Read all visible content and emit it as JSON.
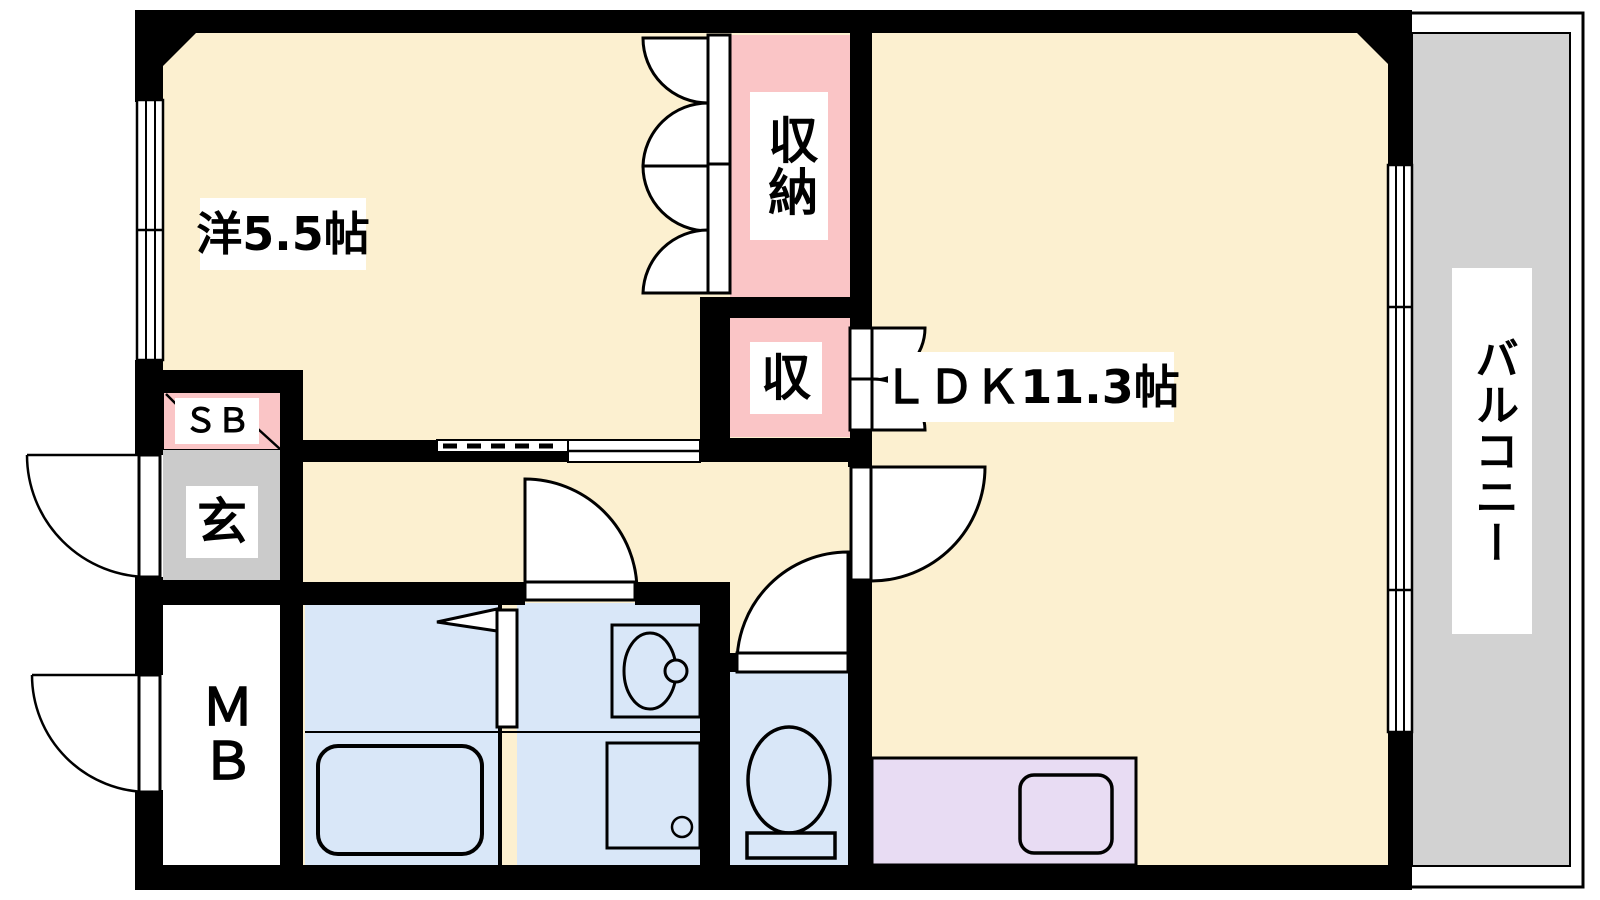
{
  "title": "apartment-floorplan-1LDK",
  "colors": {
    "room_floor": "#FCF0D0",
    "closet_pink": "#FAC5C6",
    "wet_area_blue": "#D9E7F8",
    "entrance_gray": "#CBCBCB",
    "balcony_gray": "#D2D2D2",
    "kitchen_lavender": "#E8DCF3",
    "wall_black": "#000000",
    "white": "#FFFFFF"
  },
  "rooms": {
    "western_room": {
      "label": "洋5.5帖"
    },
    "ldk": {
      "label": "ＬＤＫ11.3帖"
    },
    "closet": {
      "label": "収納"
    },
    "closet_small": {
      "label": "収"
    },
    "balcony": {
      "label": "バルコニー"
    },
    "entrance": {
      "label": "玄"
    },
    "shoe_box": {
      "label": "ＳＢ"
    },
    "meter_box": {
      "label": "ＭＢ"
    }
  }
}
